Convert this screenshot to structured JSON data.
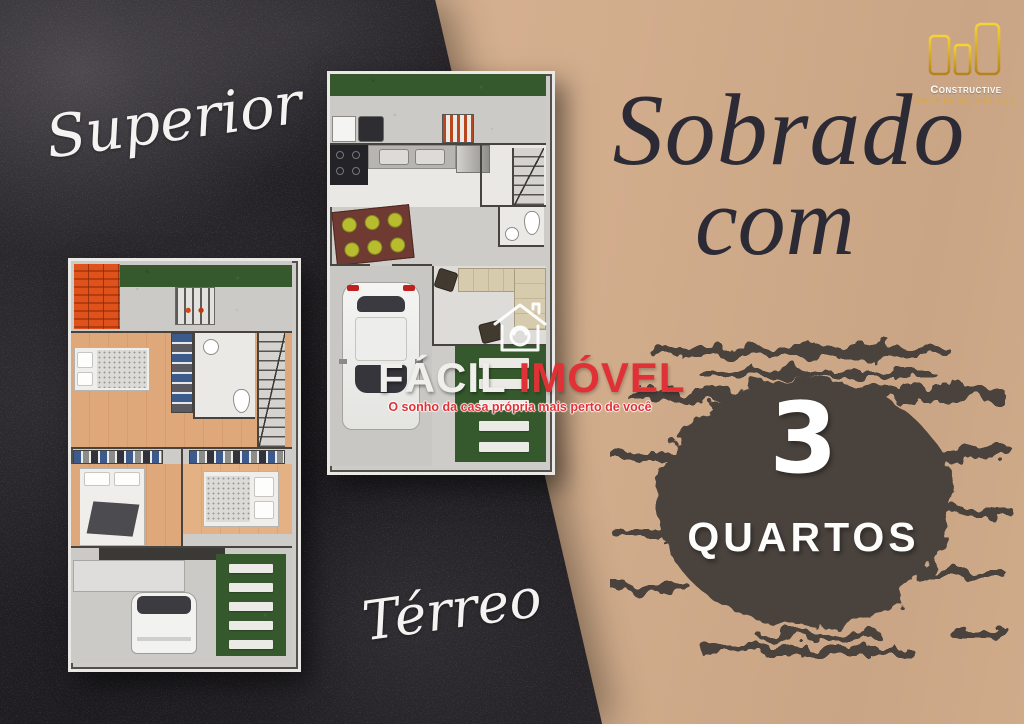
{
  "labels": {
    "superior": "Superior",
    "terreo": "Térreo"
  },
  "headline": {
    "line1": "Sobrado",
    "line2": "com"
  },
  "highlight": {
    "count": "3",
    "label": "QUARTOS"
  },
  "watermark": {
    "brand_first": "FÁCIL",
    "brand_second": "IMÓVEL",
    "tagline": "O sonho da casa própria mais perto de você"
  },
  "logo": {
    "name": "Constructive",
    "subtitle": "empreendimentos"
  },
  "colors": {
    "background_tan": "#d2ad8c",
    "background_dark": "#262428",
    "ink_splash": "#48423e",
    "brand_red": "#e03236",
    "logo_gold": "#e5b32a",
    "headline_text": "#2c2b35",
    "grass_green": "#35592c",
    "wood_floor": "#dfa87a",
    "roof_orange": "#e0521c"
  }
}
